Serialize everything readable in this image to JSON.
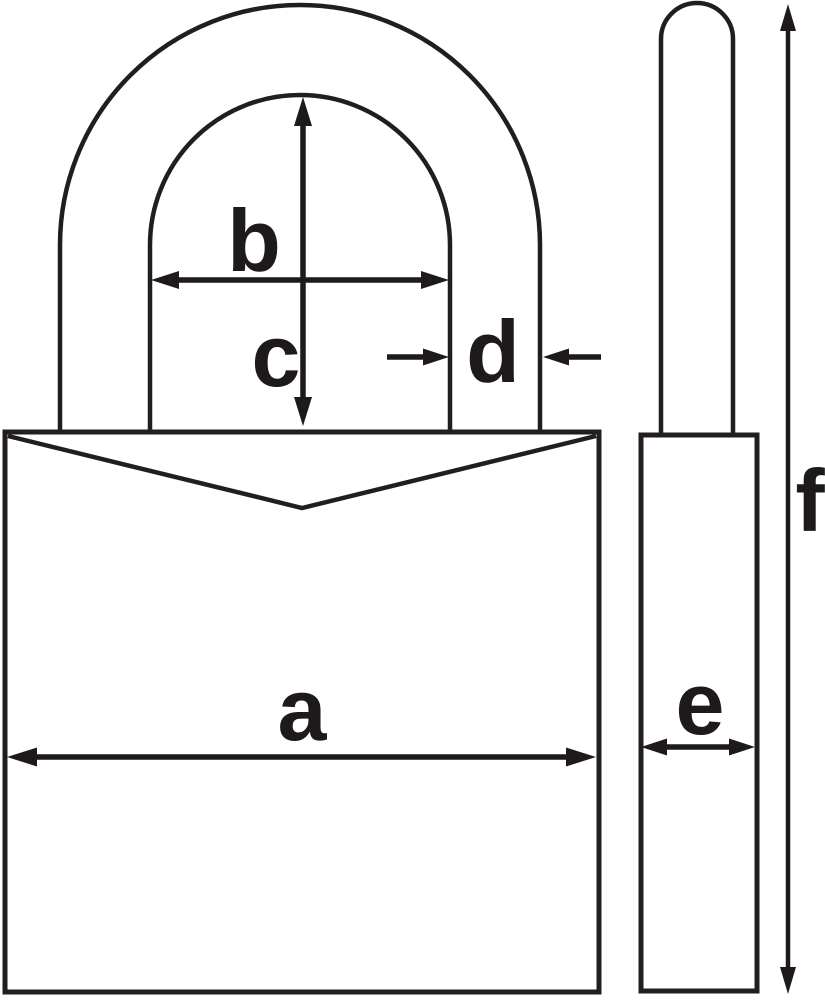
{
  "diagram": {
    "background_color": "#ffffff",
    "line_color": "#211e1d",
    "dimension_color": "#1d1a19",
    "dimensions": {
      "a": "a",
      "b": "b",
      "c": "c",
      "d": "d",
      "e": "e",
      "f": "f"
    }
  }
}
